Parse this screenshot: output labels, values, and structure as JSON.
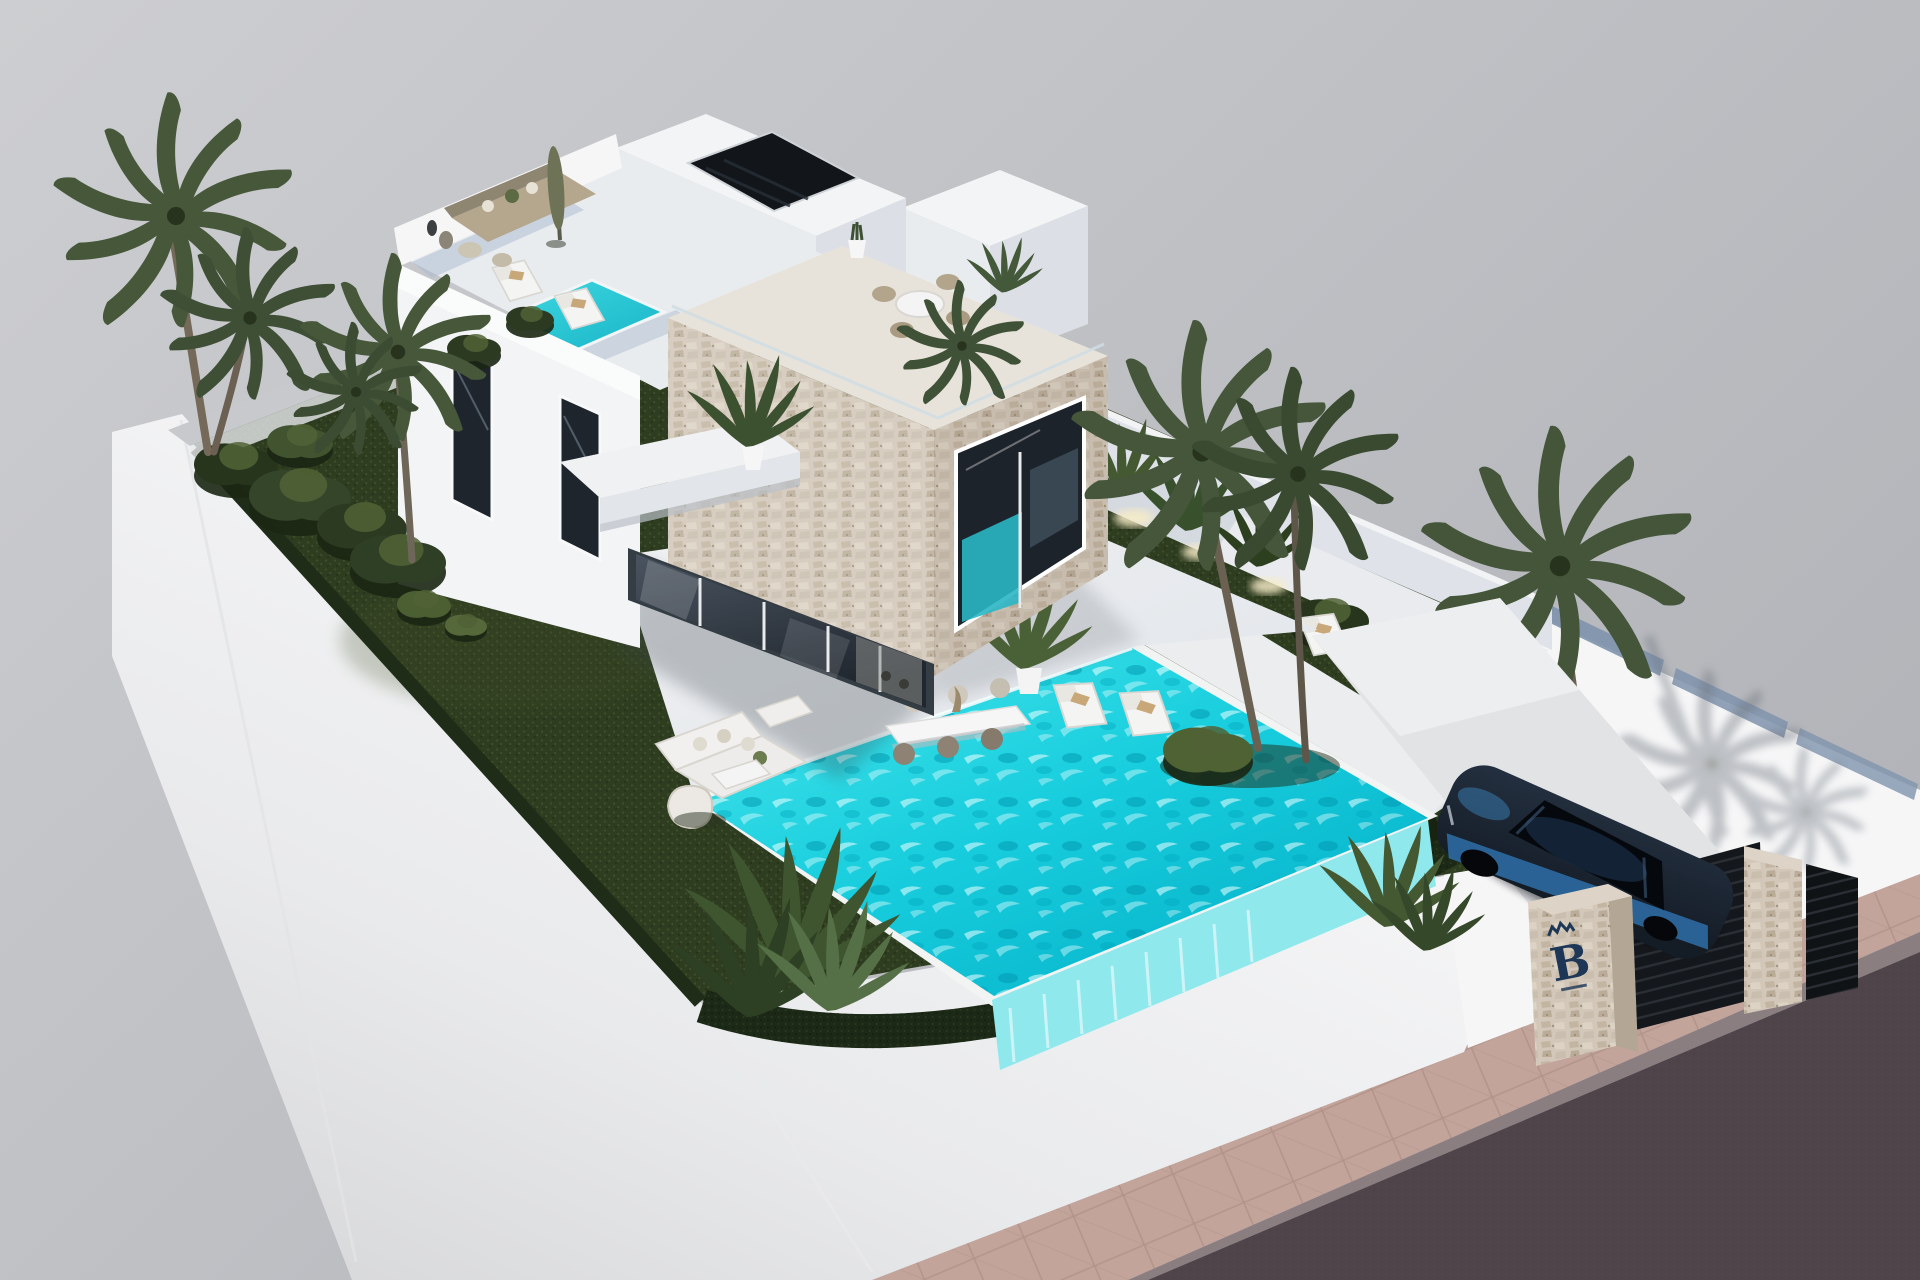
{
  "scene": {
    "description": "3D architectural rendering, aerial three-quarter view of a modern two-storey white villa with a stone-clad cube volume, roof terraces with furniture and plunge pool, landscaped walled garden with palm trees, turquoise infinity swimming pool, white patio with outdoor furniture, gated driveway with a parked dark blue car, branded stone gate pillars, paved sidewalk and asphalt road",
    "view": "aerial three-quarter view",
    "style": "3D architectural visualization"
  },
  "branding": {
    "logo_text": "B"
  },
  "objects": {
    "villa": "Two-storey white villa with stone-clad cube volume",
    "roof_terrace": "Roof terrace with lounge set, closed parasol, sun loungers and plunge pool",
    "stone_cube": "Stone-clad cube with picture window and rooftop dining terrace",
    "garden": "Landscaped garden with dark lawn, shrubs and palm trees",
    "pool": "Turquoise infinity swimming pool",
    "patio": "White patio with outdoor dining table and lounge furniture",
    "driveway": "Gated driveway with parked car",
    "car": "Dark blue car parked on the driveway",
    "gate": "Dark slatted entrance gate between stone pillars",
    "pillar": "Stone gate pillar with brand logo",
    "street": "Paved sidewalk and asphalt road",
    "perimeter_wall": "White perimeter wall around the plot"
  },
  "colors": {
    "background-top": "#cdced1",
    "background-bottom": "#b1b3b8",
    "wall-white": "#f6f6f7",
    "wall-shadow": "#d4d5d7",
    "house-face-light": "#f3f4f6",
    "house-face-medium": "#e9ecef",
    "house-face-dark": "#dce0e6",
    "stone-light": "#d5cabb",
    "stone-dark": "#c4b7a5",
    "glass-dark": "#2b323c",
    "pool-bright": "#49e6ec",
    "pool-deep": "#04aec6",
    "pool-face": "#8fe8ec",
    "grass-base": "#2e3c20",
    "grass-light": "#46572e",
    "hedge-dark": "#1c2916",
    "palm-green": "#46573a",
    "palm-light": "#556849",
    "patio-light": "#f0f1f3",
    "deck-blue": "#a9b9cf",
    "road": "#4e4449",
    "sidewalk": "#c2a49b",
    "car-body": "#141c26",
    "car-accent": "#2f6fa8",
    "logo-navy": "#1e3757",
    "uplight": "#f7ecc8"
  }
}
